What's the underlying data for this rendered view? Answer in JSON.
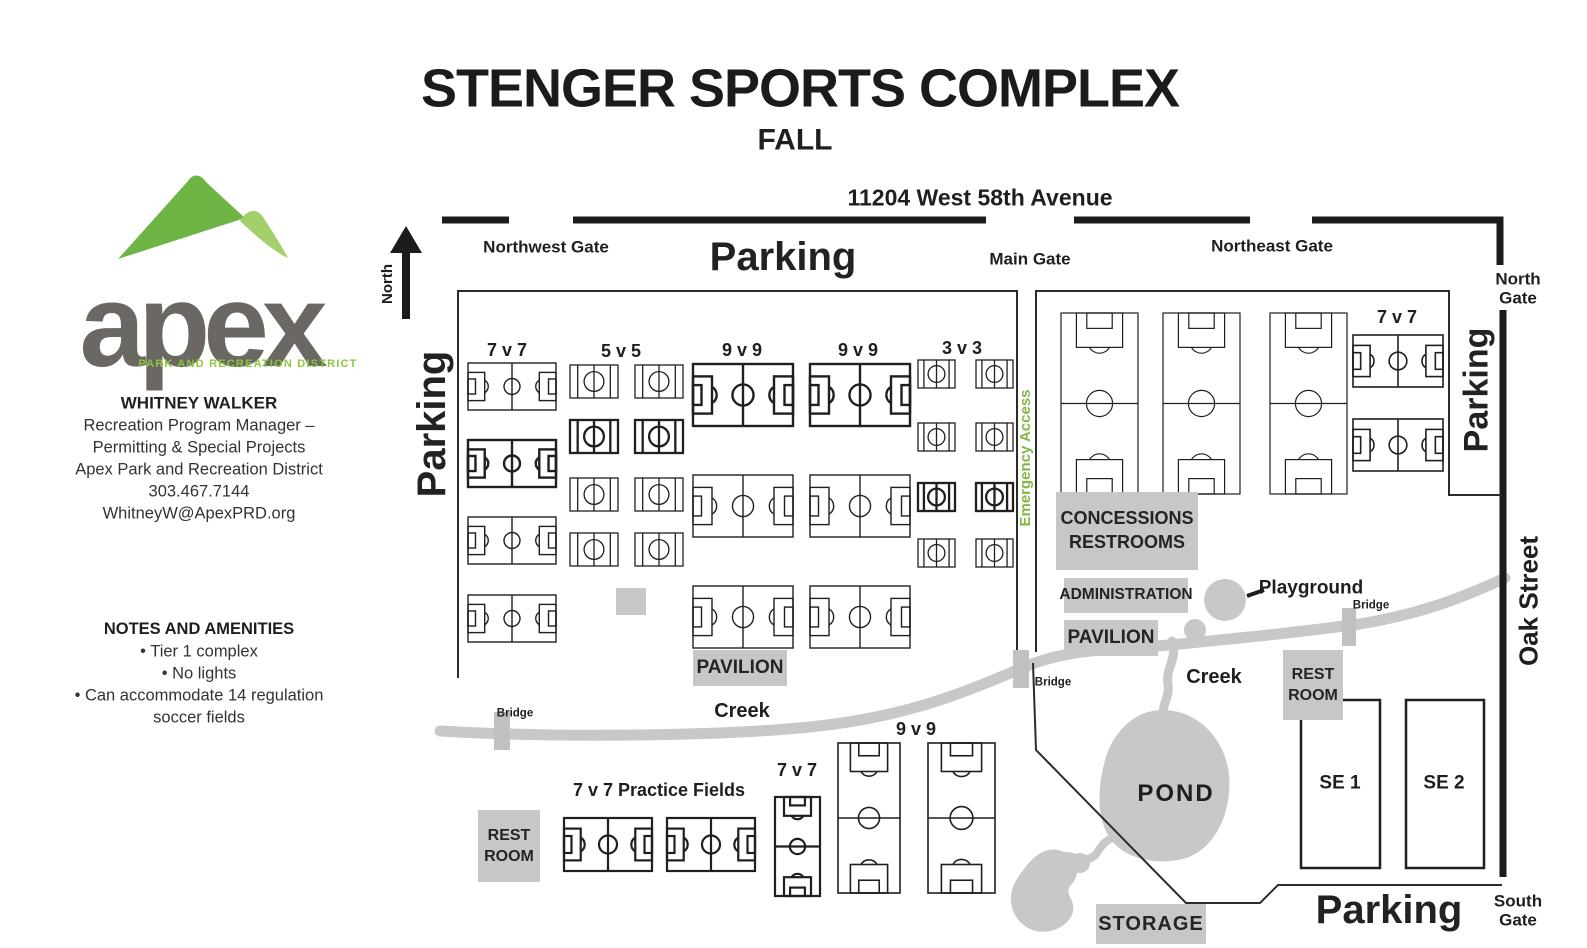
{
  "header": {
    "title": "STENGER SPORTS COMPLEX",
    "season": "FALL",
    "address": "11204 West 58th Avenue"
  },
  "sidebar": {
    "logo_word": "apex",
    "logo_tagline": "PARK AND RECREATION DISTRICT",
    "contact": {
      "name": "WHITNEY WALKER",
      "lines": [
        "Recreation Program Manager –",
        "Permitting & Special Projects",
        "Apex Park and Recreation District",
        "303.467.7144",
        "WhitneyW@ApexPRD.org"
      ]
    },
    "notes": {
      "title": "NOTES AND AMENITIES",
      "items": [
        "Tier 1 complex",
        "No lights",
        "Can accommodate 14 regulation soccer fields"
      ]
    }
  },
  "map": {
    "north_label": "North",
    "gates": {
      "northwest": "Northwest Gate",
      "main": "Main Gate",
      "northeast": "Northeast Gate",
      "north": "North Gate",
      "south": "South Gate"
    },
    "parking": {
      "top": "Parking",
      "west": "Parking",
      "east": "Parking",
      "south": "Parking"
    },
    "oak_street": "Oak Street",
    "emergency_access": "Emergency Access",
    "field_groups": {
      "w7": "7 v 7",
      "w5": "5 v 5",
      "w9a": "9 v 9",
      "w9b": "9 v 9",
      "w3": "3 v 3",
      "ne7": "7 v 7",
      "s7": "7 v 7",
      "s9": "9 v 9",
      "practice": "7 v 7 Practice Fields"
    },
    "amenities": {
      "concessions_line1": "CONCESSIONS",
      "concessions_line2": "RESTROOMS",
      "administration": "ADMINISTRATION",
      "pavilion": "PAVILION",
      "rest": "REST",
      "room": "ROOM",
      "storage": "STORAGE",
      "pond": "POND",
      "playground": "Playground",
      "creek": "Creek",
      "bridge": "Bridge",
      "se1": "SE 1",
      "se2": "SE 2"
    }
  },
  "colors": {
    "access_green": "#7fb843",
    "logo_green_dark": "#6FB545",
    "logo_green_light": "#A3CF6C",
    "tagline_green": "#8CC63F",
    "logo_gray": "#6B6762",
    "map_gray": "#C6C7C8",
    "ink": "#1E1E1E"
  }
}
